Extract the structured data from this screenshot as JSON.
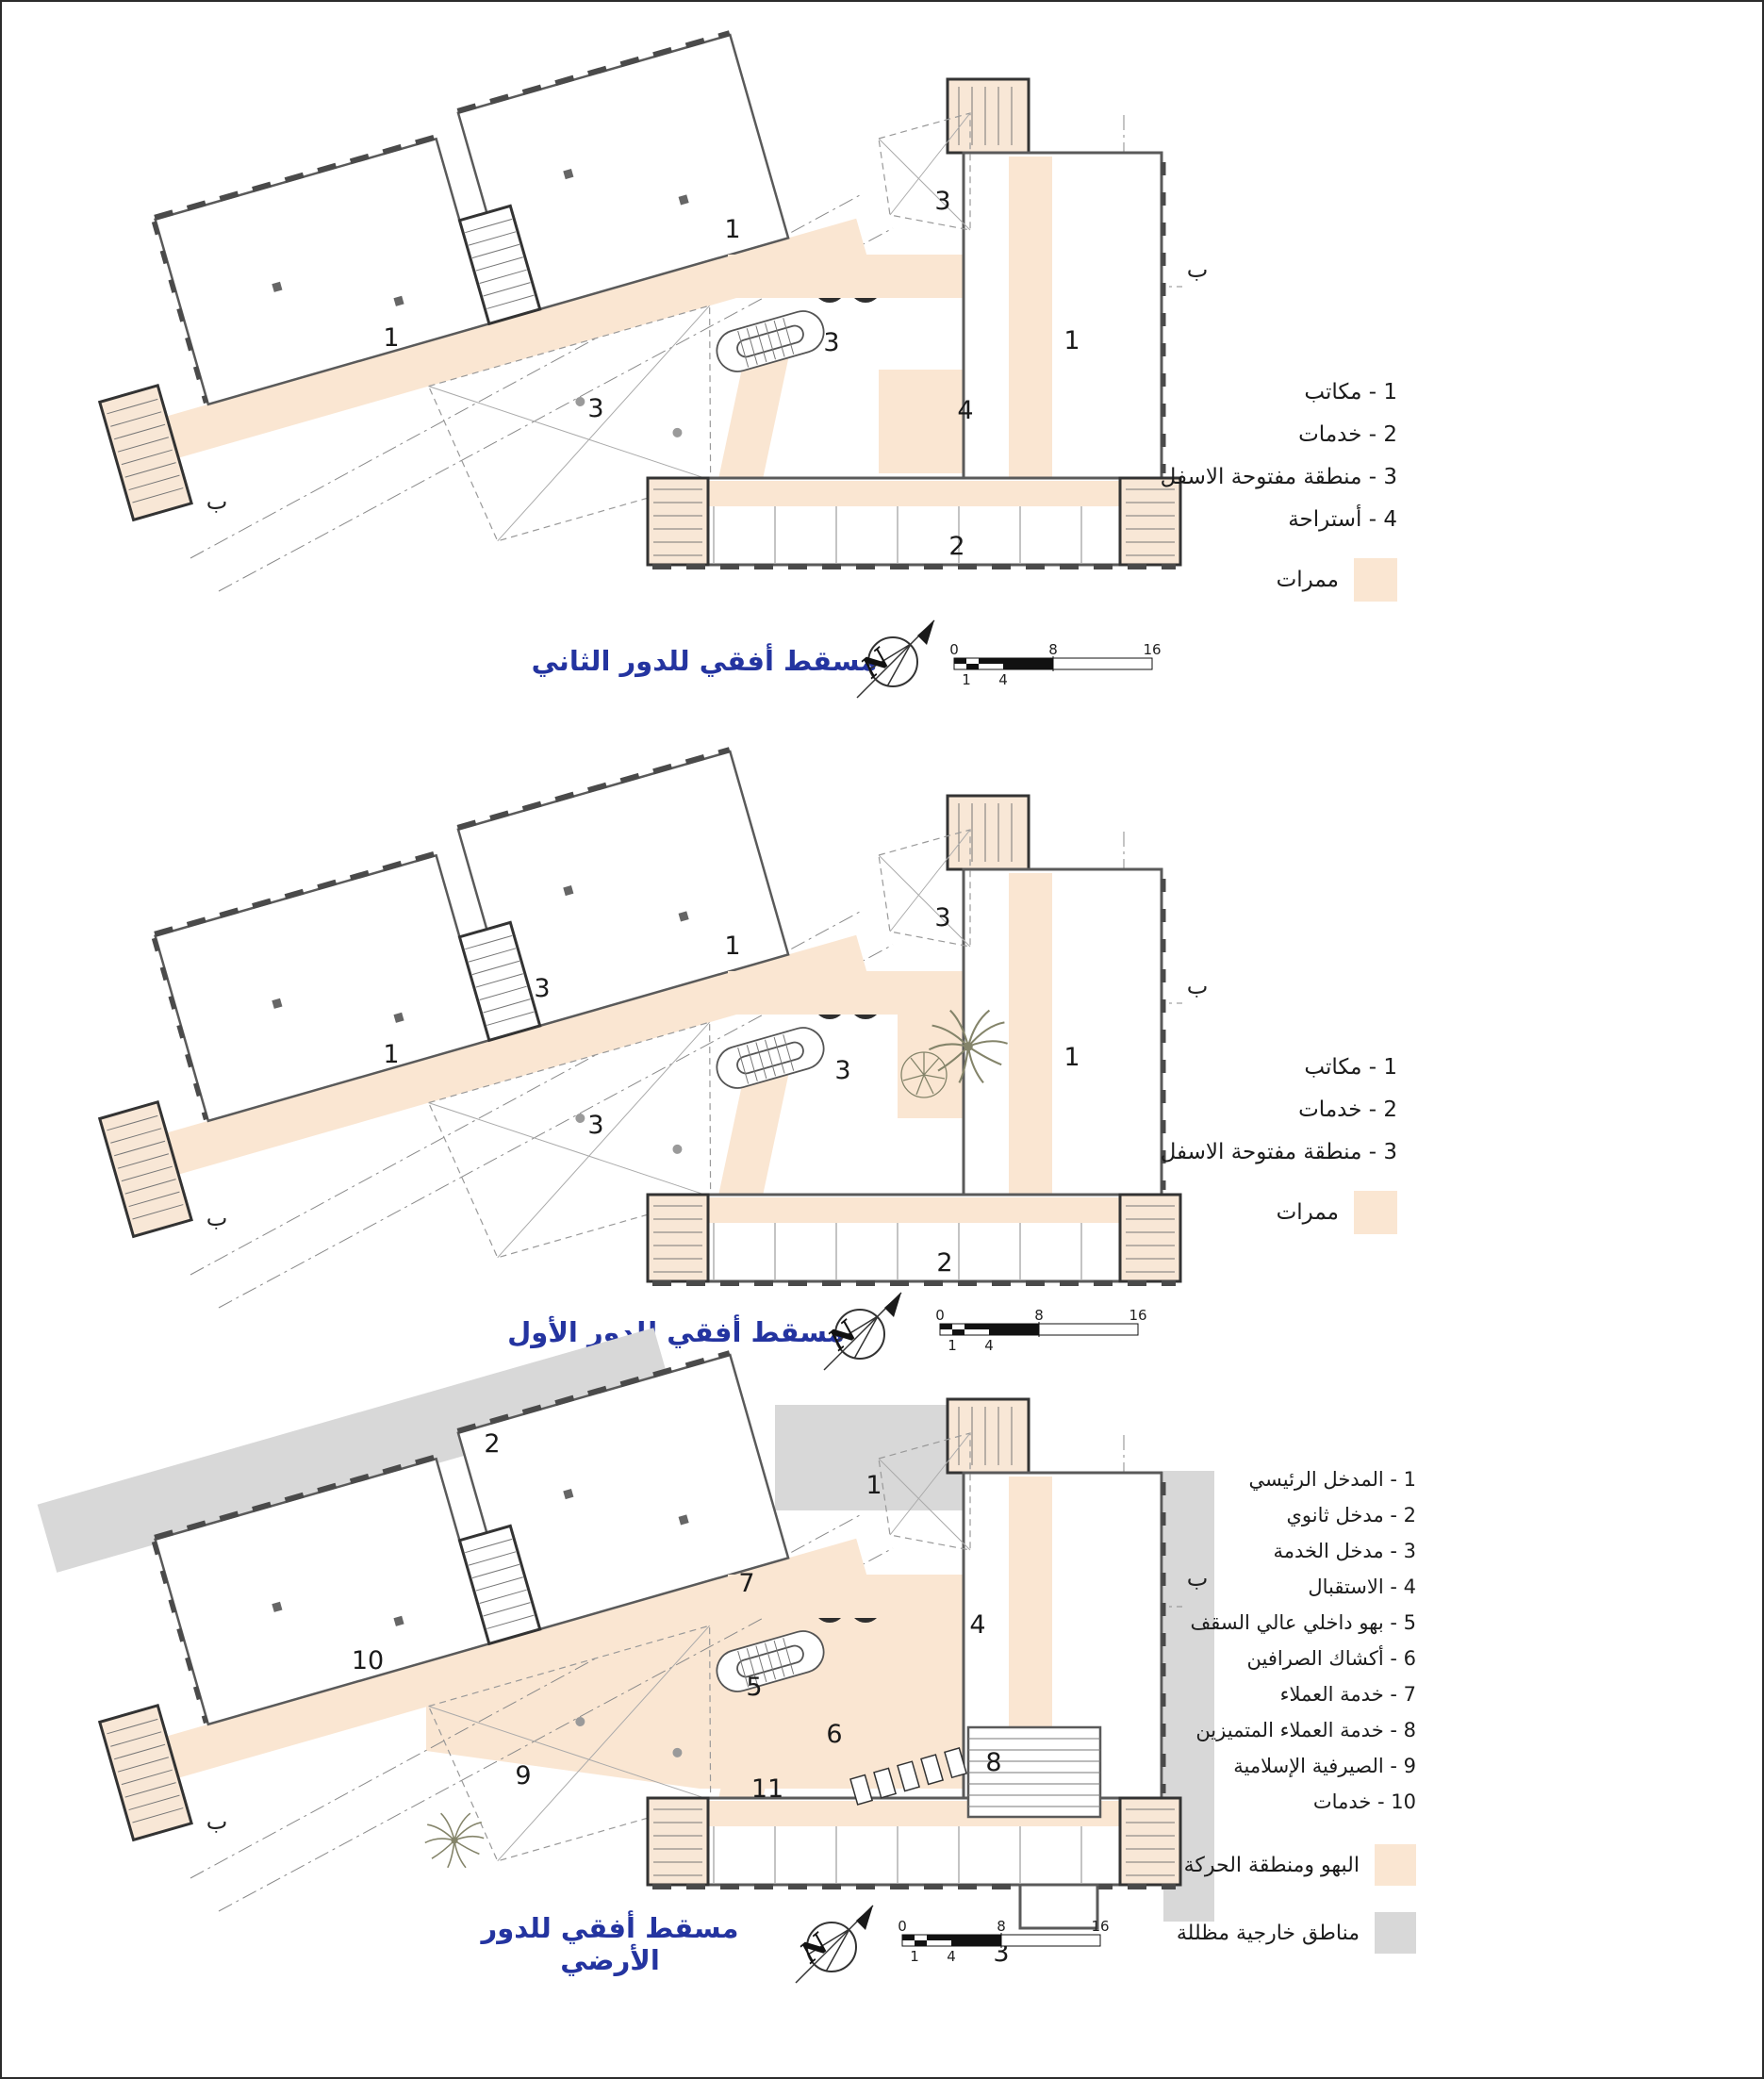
{
  "colors": {
    "circulation": "#FAE6D2",
    "shaded_outdoor": "#D8D8D8",
    "title_blue": "#2434A0",
    "wall": "#5a5a5a"
  },
  "plans": [
    {
      "title": "مسقط أفقي للدور الثاني",
      "compass_letter": "N",
      "section_marker": "ب",
      "room_labels": [
        "1",
        "3",
        "1",
        "3",
        "3",
        "4",
        "1",
        "2"
      ],
      "scale": {
        "ticks_top": [
          "0",
          "8",
          "16"
        ],
        "ticks_bottom": [
          "1",
          "4"
        ]
      },
      "legend": {
        "items": [
          "1 - مكاتب",
          "2 - خدمات",
          "3 - منطقة مفتوحة الاسفل",
          "4 - أستراحة"
        ],
        "swatches": [
          {
            "label": "ممرات",
            "color": "#FAE6D2"
          }
        ]
      }
    },
    {
      "title": "مسقط أفقي للدور الأول",
      "compass_letter": "N",
      "section_marker": "ب",
      "room_labels": [
        "1",
        "3",
        "1",
        "3",
        "3",
        "3",
        "1",
        "2"
      ],
      "scale": {
        "ticks_top": [
          "0",
          "8",
          "16"
        ],
        "ticks_bottom": [
          "1",
          "4"
        ]
      },
      "legend": {
        "items": [
          "1 - مكاتب",
          "2 - خدمات",
          "3 - منطقة مفتوحة الاسفل"
        ],
        "swatches": [
          {
            "label": "ممرات",
            "color": "#FAE6D2"
          }
        ]
      }
    },
    {
      "title": "مسقط أفقي للدور الأرضي",
      "compass_letter": "N",
      "section_marker": "ب",
      "room_labels": [
        "2",
        "1",
        "7",
        "4",
        "5",
        "6",
        "10",
        "9",
        "8",
        "11",
        "3"
      ],
      "scale": {
        "ticks_top": [
          "0",
          "8",
          "16"
        ],
        "ticks_bottom": [
          "1",
          "4"
        ]
      },
      "legend": {
        "items": [
          "1 - المدخل الرئيسي",
          "2 - مدخل ثانوي",
          "3 - مدخل الخدمة",
          "4 - الاستقبال",
          "5 - بهو داخلي عالي السقف",
          "6 - أكشاك الصرافين",
          "7 - خدمة العملاء",
          "8 - خدمة العملاء المتميزين",
          "9 - الصيرفية الإسلامية",
          "10 - خدمات"
        ],
        "swatches": [
          {
            "label": "البهو ومنطقة الحركة",
            "color": "#FAE6D2"
          },
          {
            "label": "مناطق خارجية مظللة",
            "color": "#D8D8D8"
          }
        ]
      }
    }
  ]
}
